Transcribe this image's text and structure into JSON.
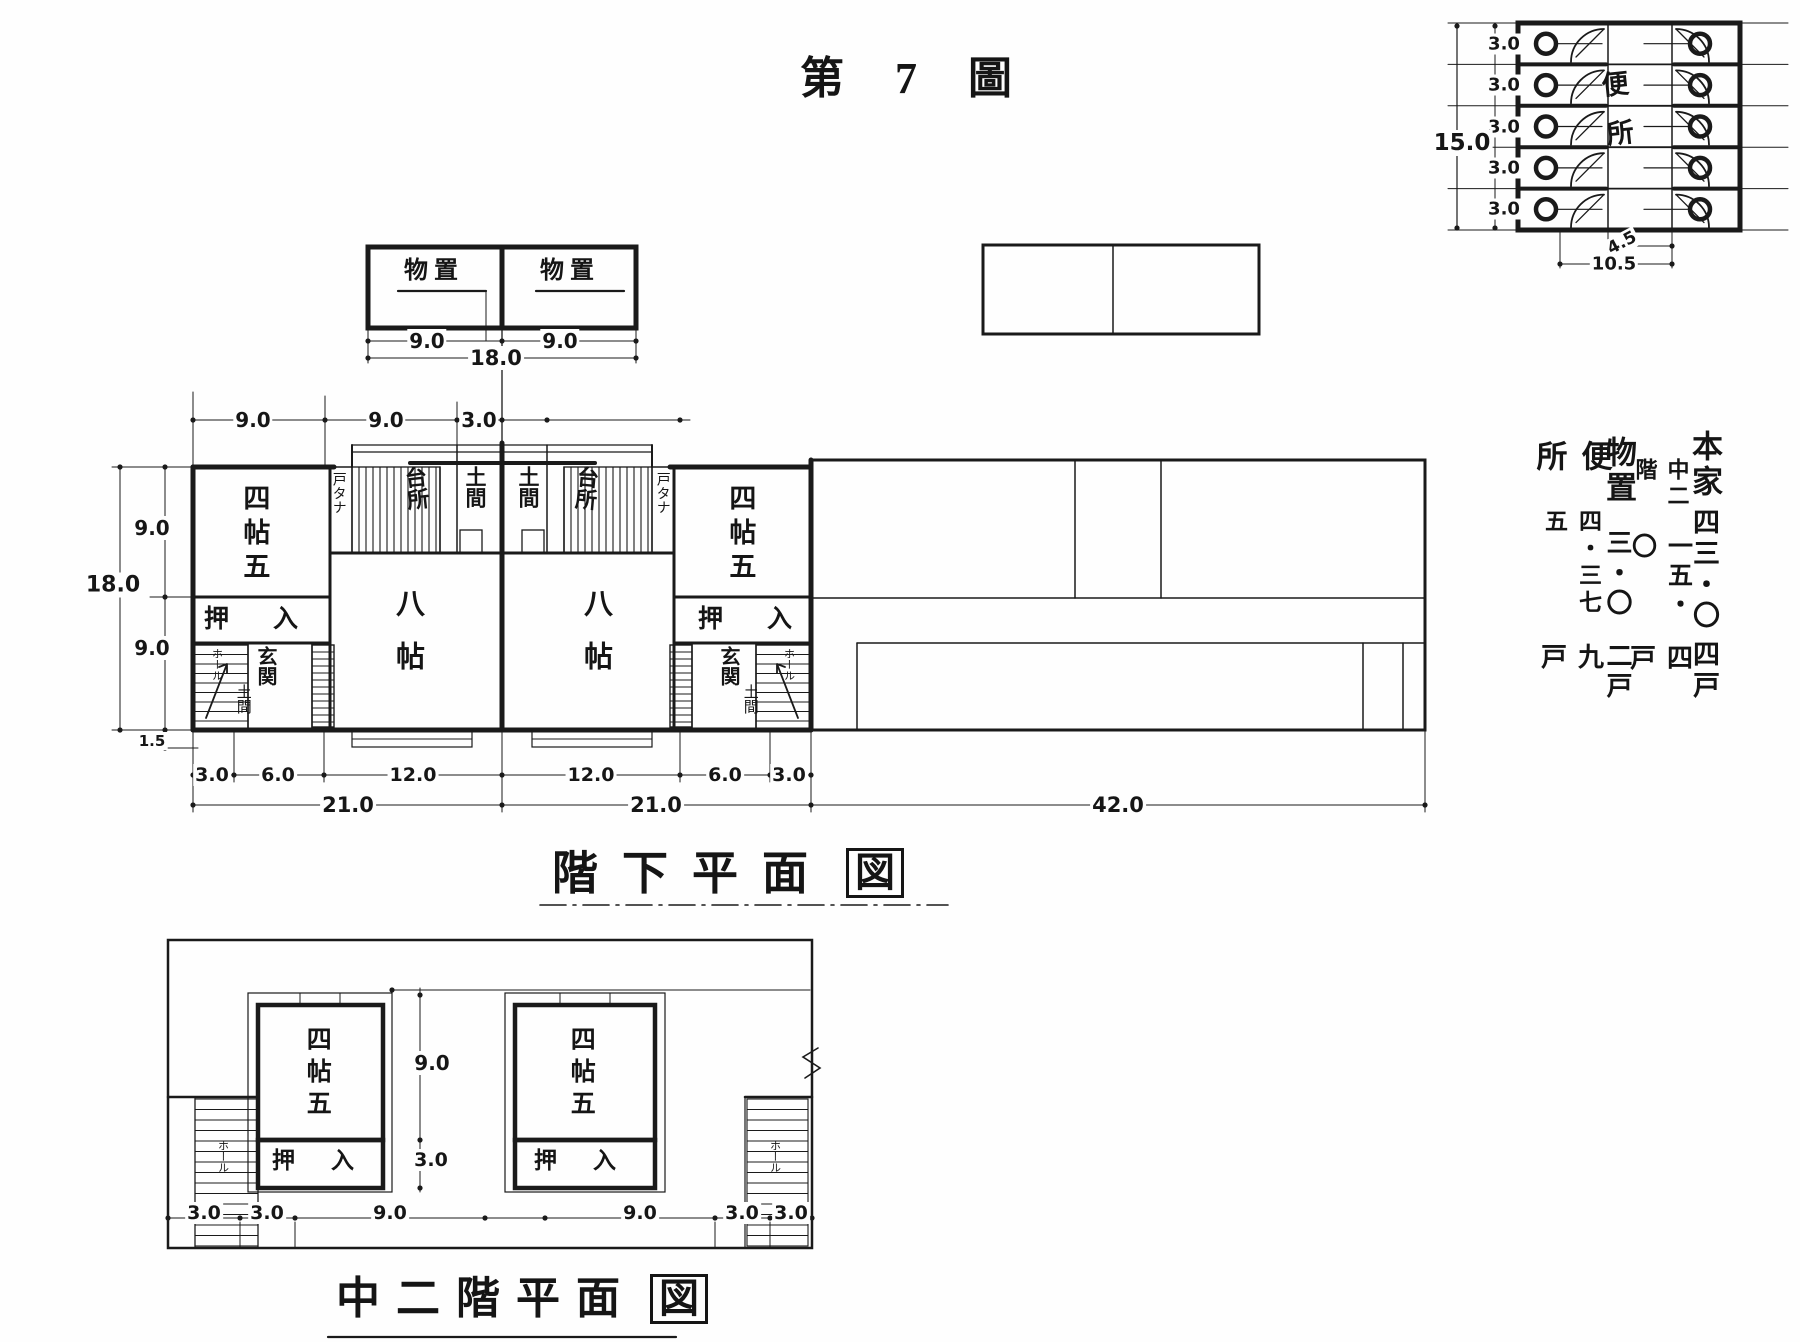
{
  "title": "第 7 圖",
  "storage_plan": {
    "left_room": "物置",
    "right_room": "物置",
    "dim_left": "9.0",
    "dim_right": "9.0",
    "dim_total": "18.0"
  },
  "toilet_plan": {
    "name": "便所",
    "row_dims": [
      "3.0",
      "3.0",
      "3.0",
      "3.0",
      "3.0"
    ],
    "dim_total": "15.0",
    "dim_stall": "4.5",
    "dim_width": "10.5"
  },
  "legend": {
    "columns": [
      {
        "name": "本家",
        "value": "四三・〇",
        "units": "四戸"
      },
      {
        "name": "中二階",
        "value": "一五・〇",
        "units": "四戸"
      },
      {
        "name": "物置",
        "value": "三・〇",
        "units": "二戸"
      },
      {
        "name": "便所",
        "value": "四・三七五",
        "units": "九戸"
      }
    ]
  },
  "ground_plan": {
    "caption": "階下平面",
    "caption_boxed": "図",
    "left_unit": {
      "room_small": "四帖五",
      "room_large": "八帖",
      "closet": "押入",
      "shelf": "戸タナ",
      "kitchen": "台所",
      "doma_top": "土間",
      "entry": "玄関",
      "doma_entry": "土間",
      "hall": "ホール"
    },
    "right_unit": {
      "room_small": "四帖五",
      "room_large": "八帖",
      "closet": "押入",
      "shelf": "戸タナ",
      "kitchen": "台所",
      "doma_top": "土間",
      "entry": "玄関",
      "doma_entry": "土間",
      "hall": "ホール"
    },
    "dims": {
      "top": [
        "9.0",
        "9.0",
        "3.0"
      ],
      "left_total": "18.0",
      "left_upper": "9.0",
      "left_lower": "9.0",
      "left_offset": "1.5",
      "bottom_row1": [
        "3.0",
        "6.0",
        "12.0",
        "12.0",
        "6.0",
        "3.0"
      ],
      "bottom_row2": [
        "21.0",
        "21.0"
      ],
      "bottom_right": "42.0"
    }
  },
  "mezzanine_plan": {
    "caption": "中二階平面",
    "caption_boxed": "図",
    "left_room": "四帖五",
    "right_room": "四帖五",
    "left_closet": "押入",
    "right_closet": "押入",
    "left_hall": "ホール",
    "right_hall": "ホール",
    "dims": {
      "room": "9.0",
      "closet": "3.0",
      "bottom": [
        "3.0",
        "3.0",
        "9.0",
        "9.0",
        "3.0",
        "3.0"
      ]
    }
  }
}
